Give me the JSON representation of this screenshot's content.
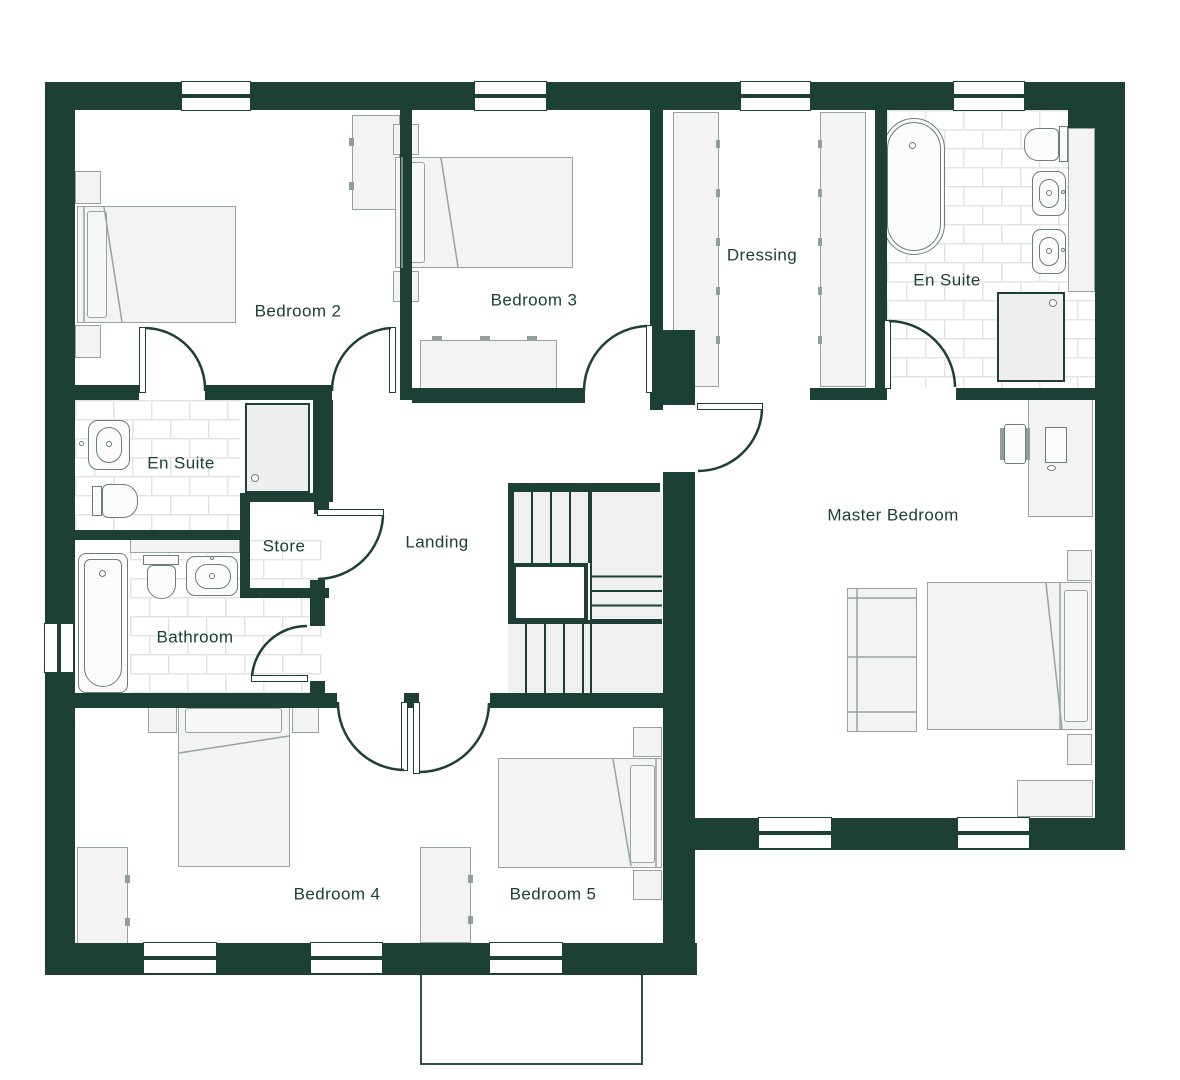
{
  "rooms": {
    "bedroom2": {
      "label": "Bedroom 2"
    },
    "bedroom3": {
      "label": "Bedroom 3"
    },
    "dressing": {
      "label": "Dressing"
    },
    "ensuite_master": {
      "label": "En Suite"
    },
    "ensuite2": {
      "label": "En Suite"
    },
    "store": {
      "label": "Store"
    },
    "landing": {
      "label": "Landing"
    },
    "bathroom": {
      "label": "Bathroom"
    },
    "master_bedroom": {
      "label": "Master Bedroom"
    },
    "bedroom4": {
      "label": "Bedroom 4"
    },
    "bedroom5": {
      "label": "Bedroom 5"
    }
  },
  "colors": {
    "wall": "#1c4036",
    "label_text": "#1b4136",
    "furniture_fill": "#f3f3f3",
    "furniture_stroke": "#96a49d",
    "fixture_stroke": "#6c7f76",
    "tile_line": "#e4e4e4"
  }
}
